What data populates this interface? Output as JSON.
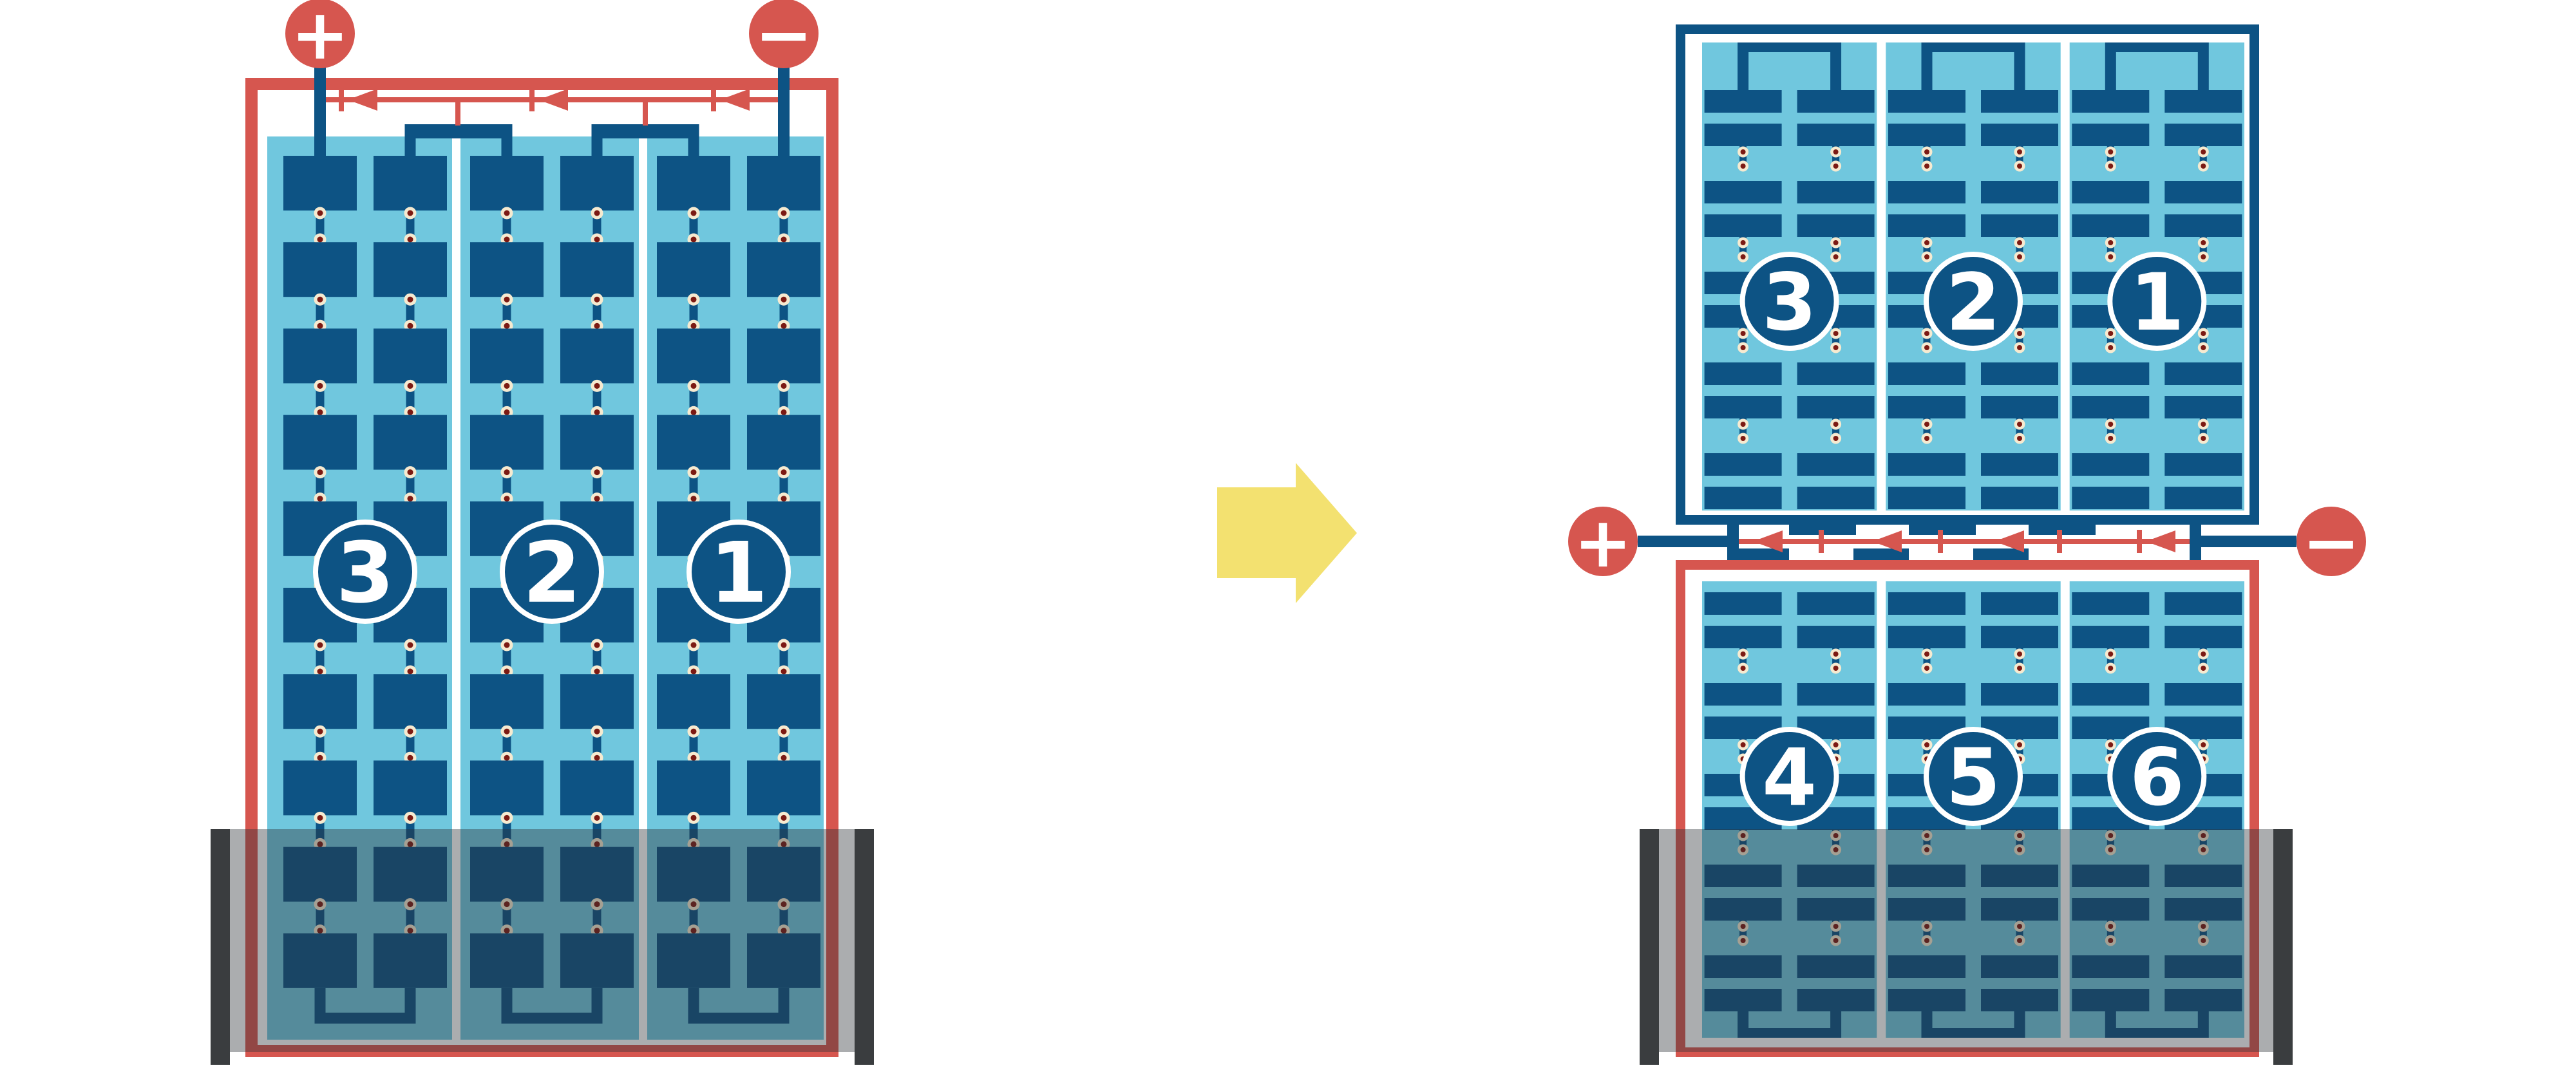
{
  "diagram_title": "",
  "terminals": {
    "positive": "+",
    "negative": "−"
  },
  "modules": {
    "left": {
      "kind": "full-cell module with bypass diodes, shaded at bottom",
      "string_labels": [
        "3",
        "2",
        "1"
      ],
      "strings": 3,
      "cell_rows": 10,
      "bypass_diode_arrows": 3
    },
    "right_top": {
      "kind": "half-cut module upper half",
      "string_labels": [
        "3",
        "2",
        "1"
      ],
      "strings": 3,
      "cell_rows": 10
    },
    "right_bottom": {
      "kind": "half-cut module lower half, shaded at bottom",
      "string_labels": [
        "4",
        "5",
        "6"
      ],
      "strings": 3,
      "cell_rows": 10,
      "bypass_diode_arrows": 4
    }
  },
  "icons": {
    "transform_arrow": "right-arrow-icon",
    "diode_arrow": "left-pointing-diode-arrow-icon"
  },
  "colors": {
    "red": "#d6564f",
    "dark_blue": "#0d5384",
    "light_blue": "#70c7de",
    "white": "#ffffff",
    "dot_outer": "#f6ead0",
    "dot_inner": "#7c1a13",
    "shade_bar": "#3a3d3f",
    "shade_overlay": "rgba(45,50,55,0.40)",
    "arrow_yellow": "#f3e170"
  }
}
